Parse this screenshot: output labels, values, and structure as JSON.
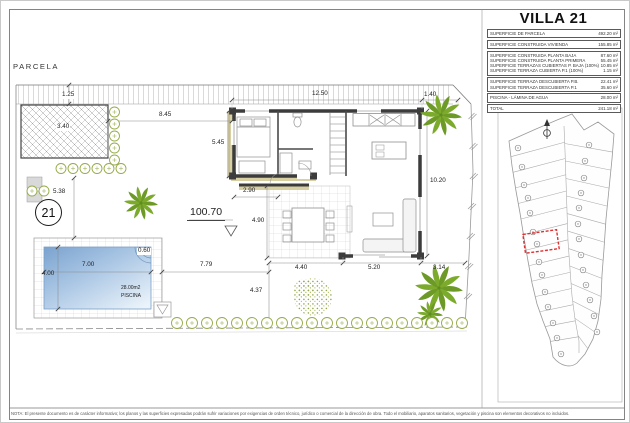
{
  "document": {
    "footer_note": "NOTA: El presente documento es de carácter informativo; los planos y las superficies expresadas podrán sufrir variaciones por exigencias de orden técnico, jurídico o comercial de la dirección de obra. Todo el mobiliario, aparatos sanitarios, vegetación y piscina son elementos decorativos no incluidos."
  },
  "plan": {
    "parcela_label": "PARCELA",
    "plot_number": "21",
    "level_value": "100.70",
    "pool_area_label": "28.00m2",
    "pool_name": "PISCINA",
    "dimensions": [
      {
        "text": "1.25",
        "x": 60,
        "y": 91,
        "cls": "bg"
      },
      {
        "text": "3.40",
        "x": 55,
        "y": 123,
        "cls": "bg"
      },
      {
        "text": "8.45",
        "x": 158,
        "y": 111
      },
      {
        "text": "12.50",
        "x": 311,
        "y": 90
      },
      {
        "text": "1.40",
        "x": 423,
        "y": 91
      },
      {
        "text": "5.45",
        "x": 211,
        "y": 139
      },
      {
        "text": "2.90",
        "x": 242,
        "y": 187
      },
      {
        "text": "10.20",
        "x": 429,
        "y": 177
      },
      {
        "text": "4.90",
        "x": 250,
        "y": 217,
        "cls": "bg"
      },
      {
        "text": "5.38",
        "x": 52,
        "y": 188
      },
      {
        "text": "0.60",
        "x": 136,
        "y": 247,
        "cls": "bg"
      },
      {
        "text": "7.00",
        "x": 81,
        "y": 261
      },
      {
        "text": "4.00",
        "x": 41,
        "y": 270
      },
      {
        "text": "7.79",
        "x": 199,
        "y": 261
      },
      {
        "text": "4.37",
        "x": 249,
        "y": 287
      },
      {
        "text": "4.40",
        "x": 294,
        "y": 264
      },
      {
        "text": "5.20",
        "x": 367,
        "y": 264
      },
      {
        "text": "3.14",
        "x": 432,
        "y": 264
      }
    ]
  },
  "panel": {
    "title": "VILLA 21",
    "table": {
      "groups": [
        {
          "rows": [
            {
              "label": "SUPERFICIE DE PARCELA",
              "value": "492.20 m²"
            }
          ]
        },
        {
          "rows": [
            {
              "label": "SUPERFICIE CONSTRUIDA VIVIENDA",
              "value": "155.85 m²"
            }
          ]
        },
        {
          "rows": [
            {
              "label": "SUPERFICIE CONSTRUIDA PLANTA BAJA",
              "value": "87.60 m²"
            },
            {
              "label": "SUPERFICIE CONSTRUIDA PLANTA PRIMERA",
              "value": "55.45 m²"
            },
            {
              "label": "SUPERFICIE TERRAZAS CUBIERTAS P. BAJA (100%)",
              "value": "10.85 m²"
            },
            {
              "label": "SUPERFICIE TERRAZA CUBIERTA P.1 (100%)",
              "value": "1.15 m²"
            }
          ]
        },
        {
          "rows": [
            {
              "label": "SUPERFICIE TERRAZA DESCUBIERTA P.B.",
              "value": "22.41 m²"
            },
            {
              "label": "SUPERFICIE TERRAZA DESCUBIERTA P.1",
              "value": "35.60 m²"
            }
          ]
        },
        {
          "rows": [
            {
              "label": "PISCINA - LÁMINA DE AGUA",
              "value": "28.00 m²"
            }
          ]
        },
        {
          "rows": [
            {
              "label": "TOTAL",
              "value": "241.18 m²"
            }
          ]
        }
      ]
    },
    "site_map": {
      "highlight_color": "#e03030"
    }
  },
  "colors": {
    "wall": "#3c3c3c",
    "greenery": "#7cab2c",
    "bush_outline": "#94ab48",
    "pool_dark": "#7aa3cf",
    "pool_light": "#eaf3fa",
    "dim_text": "#222222"
  }
}
